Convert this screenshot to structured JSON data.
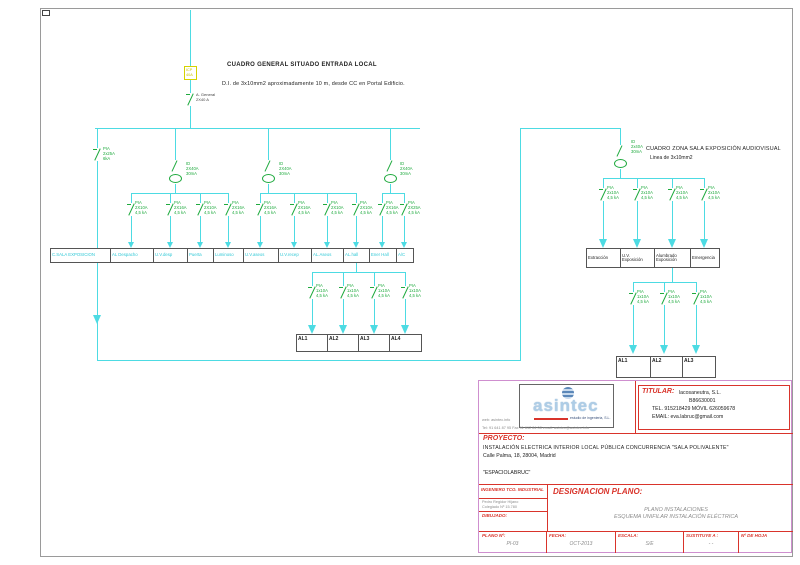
{
  "schematic": {
    "general": {
      "title": "CUADRO GENERAL SITUADO ENTRADA LOCAL",
      "subtitle": "D.I. de 3x10mm2 aproximadamente 10 m, desde CC en Portal Edificio.",
      "icp": "ICP\n40A",
      "main_switch": "A. General\n2X40 A",
      "main_breaker": "PIA\n2x25A\n6kA",
      "rcd": "ID\n2X40A\n30mA",
      "bus_cells": [
        "C.SALA EXPOSICION",
        "AL Despacho",
        "U.V.desp",
        "Puerta",
        "Luminoso",
        "U.V.aseos",
        "U.V.recep",
        "AL.Aseos",
        "AL.hall",
        "Ener Hall",
        "A/C"
      ],
      "branch_breakers": [
        "PIA\n2X10A\n4,5 kA",
        "PIA\n2X16A\n4,5 kA",
        "PIA\n2X10A\n4,5 kA",
        "PIA\n2X16A\n4,5 kA",
        "PIA\n2X16A\n4,5 kA",
        "PIA\n2X16A\n4,5 kA",
        "PIA\n2X10A\n4,5 kA",
        "PIA\n2X10A\n4,5 kA",
        "PIA\n2X16A\n4,5 kA",
        "PIA\n2X25A\n4,5 kA"
      ],
      "al_breaker": "PIA\n1x10A\n4,5 kA",
      "al_boxes": [
        "AL1",
        "AL2",
        "AL3",
        "AL4"
      ]
    },
    "zone": {
      "title": "CUADRO ZONA SALA EXPOSICIÓN AUDIOVISUAL",
      "subtitle": "Linea de 3x10mm2",
      "rcd": "ID\n2x40A\n30mA",
      "branch_breaker": "PIA\n2x10A\n4,5 kA",
      "bus_cells": [
        "Extracción",
        "U.V.\nExposición",
        "Alumbrado\nExposición",
        "Emergencia"
      ],
      "al_breaker": "PIA\n1x10A\n4,5 kA",
      "al_boxes": [
        "AL1",
        "AL2",
        "AL3"
      ]
    }
  },
  "title_block": {
    "logo": {
      "name": "asintec",
      "tagline": "estudio de ingenieria, S.L.",
      "web": "web: asintec.info",
      "contact": "Tel: 91 641 87 95    Fax 91 612 84 08    email: asintec@asintec.info"
    },
    "titular": {
      "label": "TITULAR:",
      "name": "lacosaneutra,  S.L.",
      "cif": "B86630001",
      "phone": "TEL.  915218429  MÓVIL  626059678",
      "email": "EMAIL:  eva.labruc@gmail.com"
    },
    "proyecto": {
      "label": "PROYECTO:",
      "line1": "INSTALACIÓN  ELECTRICA  INTERIOR  LOCAL  PÚBLICA  CONCURRENCIA  \"SALA  POLIVALENTE\"",
      "line2": "Calle  Palma,  18,  28004,  Madrid",
      "line3": "\"ESPACIOLABRUC\""
    },
    "engineer": {
      "header": "INGENIERO TCO. INDUSTRIAL",
      "name": "Pedro Regidor Hijano",
      "num": "Colegiado Nº  15.780",
      "drawn": "DIBUJADO:"
    },
    "designacion": {
      "label": "DESIGNACION PLANO:",
      "line1": "PLANO INSTALACIONES",
      "line2": "ESQUEMA UNIFILAR INSTALACIÓN ELÉCTRICA"
    },
    "footer": {
      "plano_label": "PLANO Nº:",
      "plano": "PI-03",
      "fecha_label": "FECHA:",
      "fecha": "OCT-2013",
      "escala_label": "ESCALA:",
      "escala": "S/E",
      "sust_label": "SUSTITUYE A :",
      "sust": "- -",
      "hoja_label": "Nº DE HOJA",
      "hoja": ""
    }
  }
}
